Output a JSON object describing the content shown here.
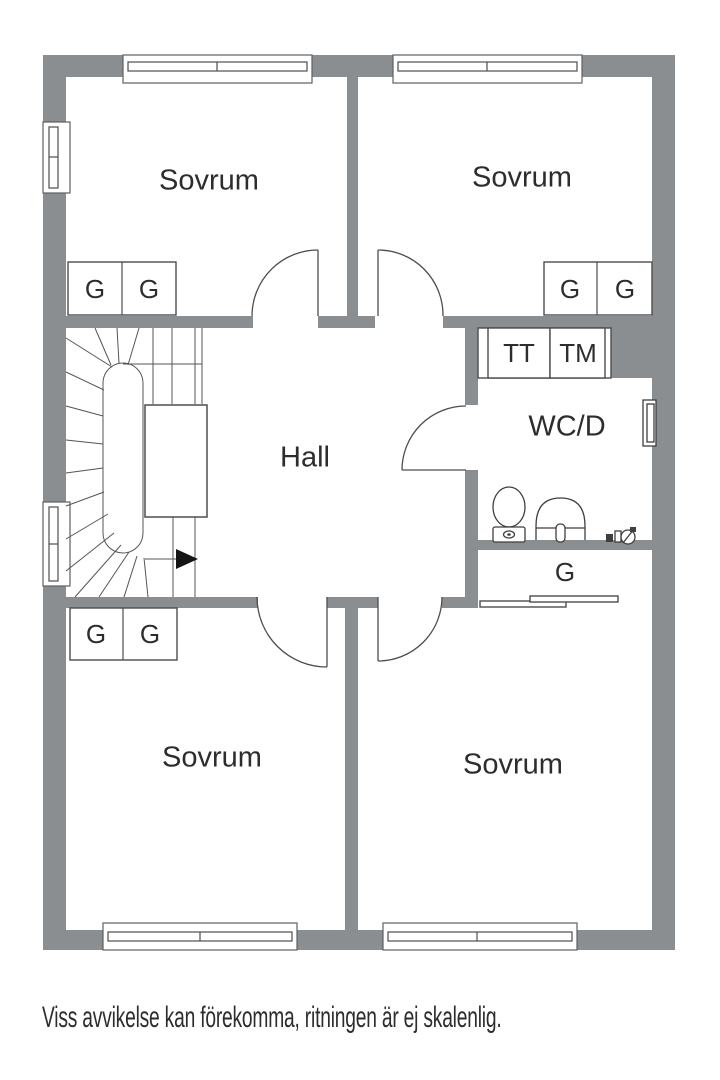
{
  "floor_plan": {
    "rooms": [
      {
        "id": "bedroom-top-left",
        "label": "Sovrum"
      },
      {
        "id": "bedroom-top-right",
        "label": "Sovrum"
      },
      {
        "id": "hall",
        "label": "Hall"
      },
      {
        "id": "bathroom",
        "label": "WC/D"
      },
      {
        "id": "bedroom-bottom-left",
        "label": "Sovrum"
      },
      {
        "id": "bedroom-bottom-right",
        "label": "Sovrum"
      },
      {
        "id": "closet",
        "label": "G"
      }
    ],
    "appliances": [
      {
        "id": "tumble-dryer",
        "label": "TT"
      },
      {
        "id": "washing-machine",
        "label": "TM"
      }
    ],
    "wardrobes": {
      "label": "G",
      "count": 6
    },
    "icons": {
      "stair_direction": "right-arrow",
      "toilet": "toilet-icon",
      "sink": "sink-icon",
      "floor_drain": "floor-drain-icon",
      "stairs": "winder-staircase",
      "windows": "window-icon",
      "doors": "door-swing-icon"
    }
  },
  "caption": "Viss avvikelse kan förekomma, ritningen är ej skalenlig.",
  "colors": {
    "wall": "#8a8e90",
    "line": "#4d4d4d",
    "text": "#2d2d2d",
    "background": "#ffffff"
  }
}
